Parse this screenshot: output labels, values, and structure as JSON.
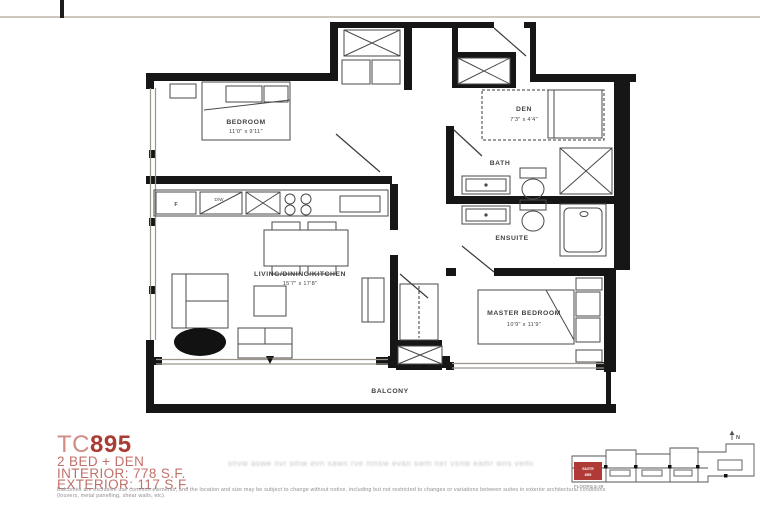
{
  "plan": {
    "bedroom": {
      "name": "BEDROOM",
      "dims": "11'0\" x 9'11\""
    },
    "den": {
      "name": "DEN",
      "dims": "7'3\" x 4'4\""
    },
    "bath": {
      "name": "BATH"
    },
    "ensuite": {
      "name": "ENSUITE"
    },
    "living": {
      "name": "LIVING/DINING/KITCHEN",
      "dims": "15'7\" x 17'8\""
    },
    "master": {
      "name": "MASTER BEDROOM",
      "dims": "10'9\" x 11'9\""
    },
    "balcony": {
      "name": "BALCONY"
    },
    "fridge_label": "F",
    "dishwasher_label": "D/W"
  },
  "info": {
    "model_prefix": "TC",
    "model_number": "895",
    "type": "2 BED + DEN",
    "interior": "INTERIOR: 778 S.F.",
    "exterior": "EXTERIOR: 117 S.F.",
    "accent_color": "#a93c34"
  },
  "watermark_text": "snvw aswe nvr smw evn sawn rve mnsw evan swm ner vsnw eamr wns vema snwr evm answ",
  "disclaimer": {
    "line1": "Balconies are exclusive use common elements, and the location and size may be subject to change without notice, including but not restricted to changes or variations between suites in exterior architectural conditions",
    "line2": "(louvers, metal panelling, shear walls, etc)."
  },
  "keyplan": {
    "unit_line1": "SUITE",
    "unit_line2": "895",
    "floors": "FLOORS 5-29",
    "north": "N"
  }
}
